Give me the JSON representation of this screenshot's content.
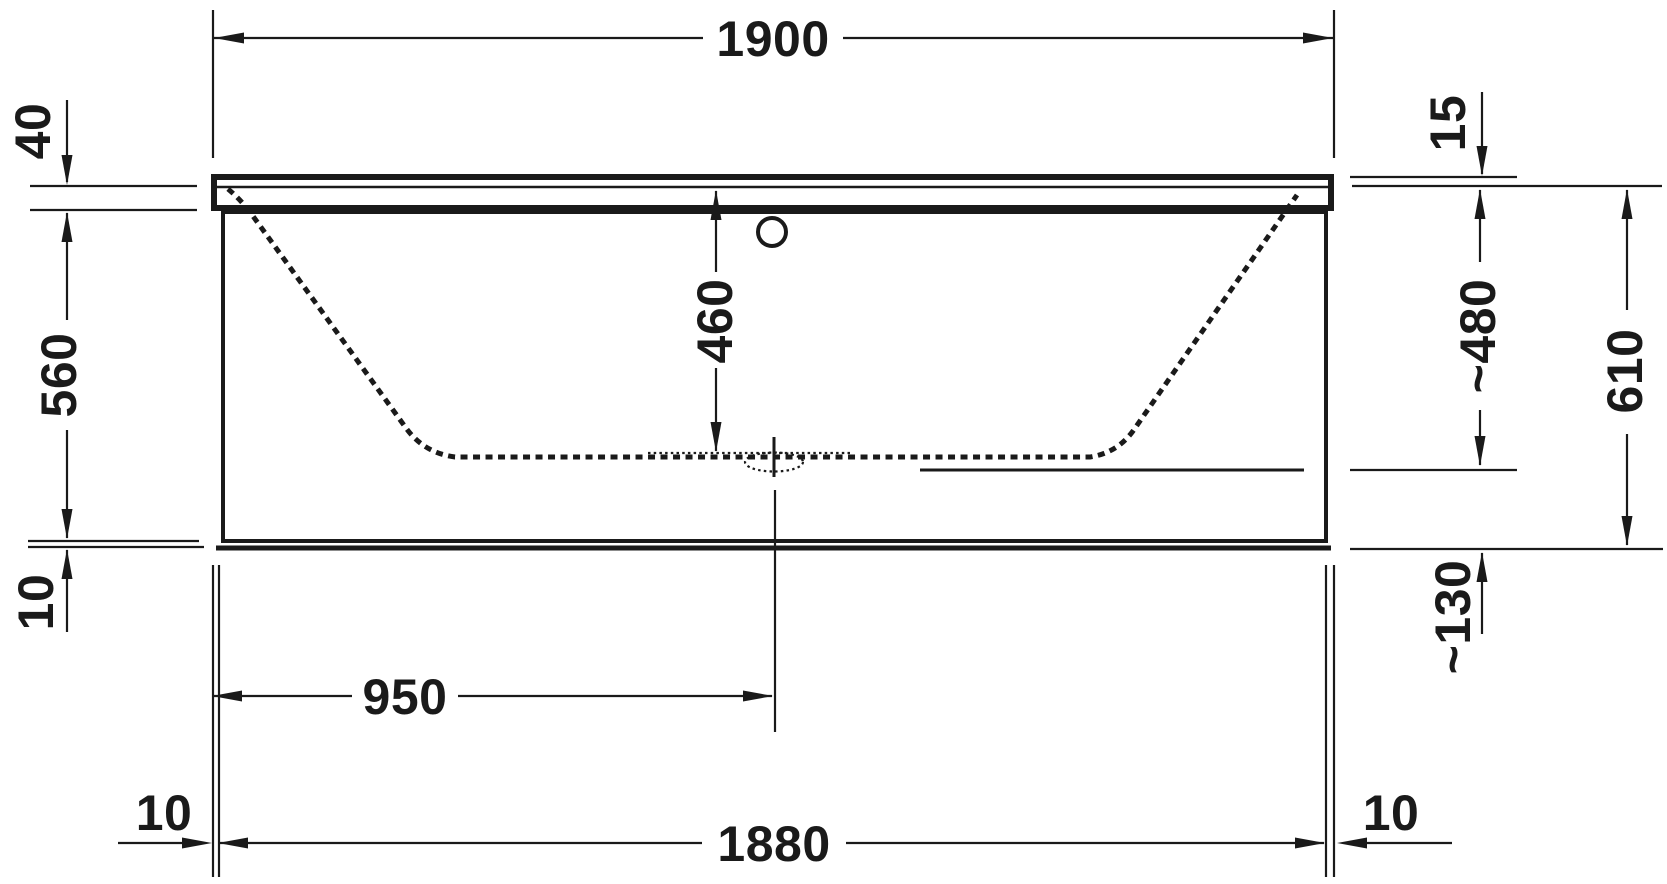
{
  "drawing": {
    "type": "bathtub-front-elevation-technical-drawing",
    "unit": "mm",
    "line_color": "#1a1a1a",
    "background_color": "#ffffff",
    "dims": {
      "overall_length": "1900",
      "rim_edge_height": "40",
      "apron_height": "560",
      "base_gap_left": "10",
      "inner_depth": "460",
      "rim_top_inset": "15",
      "rim_to_inner_floor": "~480",
      "inner_floor_to_base": "~130",
      "overall_height": "610",
      "drain_center_from_left": "950",
      "body_length": "1880",
      "rim_overhang_left": "10",
      "rim_overhang_right": "10"
    }
  }
}
